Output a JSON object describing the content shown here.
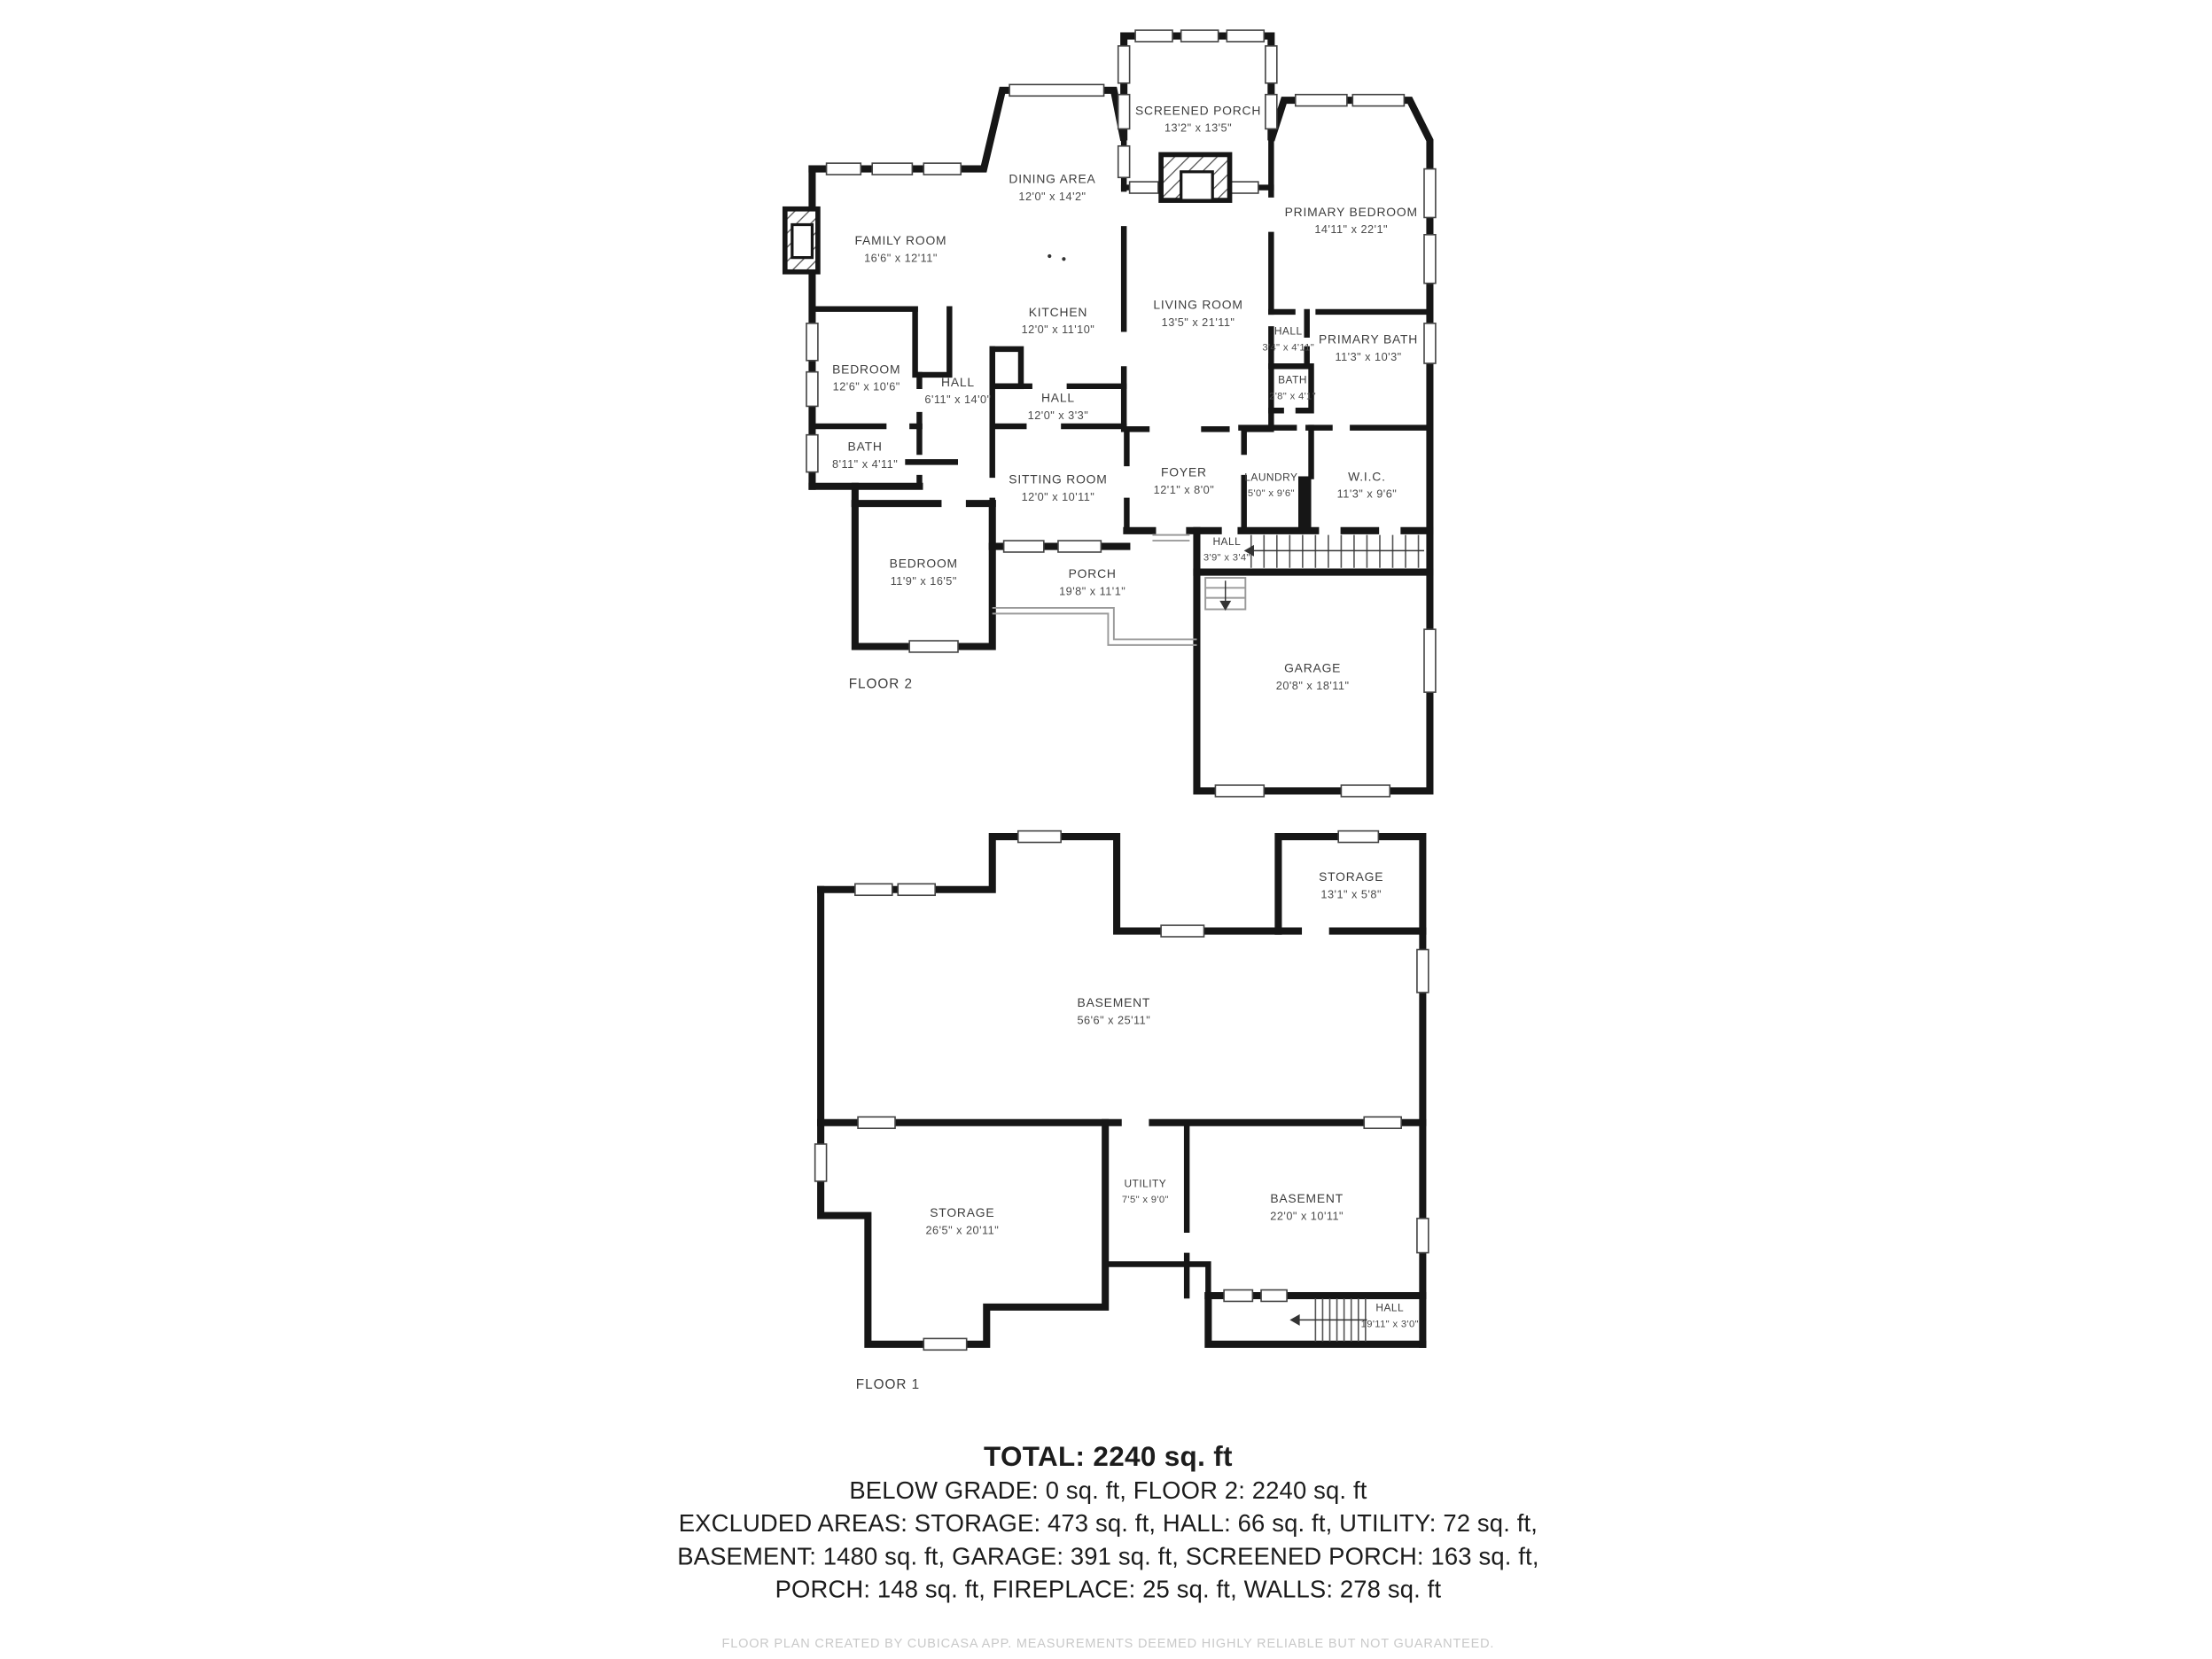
{
  "title": "Floor plan",
  "colors": {
    "background": "#ffffff",
    "wall": "#161616",
    "room_label": "#3d3d3d",
    "dim_label": "#4a4a4a",
    "summary_text": "#1c1c1c",
    "footer_text": "#c9c9c9"
  },
  "floor2": {
    "label": "FLOOR 2",
    "rooms": [
      {
        "name": "SCREENED PORCH",
        "dims": "13'2\" x 13'5\""
      },
      {
        "name": "DINING AREA",
        "dims": "12'0\" x 14'2\""
      },
      {
        "name": "FAMILY ROOM",
        "dims": "16'6\" x 12'11\""
      },
      {
        "name": "PRIMARY BEDROOM",
        "dims": "14'11\" x 22'1\""
      },
      {
        "name": "KITCHEN",
        "dims": "12'0\" x 11'10\""
      },
      {
        "name": "LIVING ROOM",
        "dims": "13'5\" x 21'11\""
      },
      {
        "name": "BEDROOM",
        "dims": "12'6\" x 10'6\""
      },
      {
        "name": "HALL",
        "dims": "6'11\" x 14'0\""
      },
      {
        "name": "HALL",
        "dims": "12'0\" x 3'3\""
      },
      {
        "name": "HALL",
        "dims": "3'4\" x 4'11\""
      },
      {
        "name": "PRIMARY BATH",
        "dims": "11'3\" x 10'3\""
      },
      {
        "name": "BATH",
        "dims": "2'8\" x 4'1\""
      },
      {
        "name": "BATH",
        "dims": "8'11\" x 4'11\""
      },
      {
        "name": "SITTING ROOM",
        "dims": "12'0\" x 10'11\""
      },
      {
        "name": "FOYER",
        "dims": "12'1\" x 8'0\""
      },
      {
        "name": "LAUNDRY",
        "dims": "5'0\" x 9'6\""
      },
      {
        "name": "W.I.C.",
        "dims": "11'3\" x 9'6\""
      },
      {
        "name": "BEDROOM",
        "dims": "11'9\" x 16'5\""
      },
      {
        "name": "PORCH",
        "dims": "19'8\" x 11'1\""
      },
      {
        "name": "HALL",
        "dims": "3'9\" x 3'4\""
      },
      {
        "name": "GARAGE",
        "dims": "20'8\" x 18'11\""
      }
    ]
  },
  "floor1": {
    "label": "FLOOR 1",
    "rooms": [
      {
        "name": "STORAGE",
        "dims": "13'1\" x 5'8\""
      },
      {
        "name": "BASEMENT",
        "dims": "56'6\" x 25'11\""
      },
      {
        "name": "UTILITY",
        "dims": "7'5\" x 9'0\""
      },
      {
        "name": "BASEMENT",
        "dims": "22'0\" x 10'11\""
      },
      {
        "name": "STORAGE",
        "dims": "26'5\" x 20'11\""
      },
      {
        "name": "HALL",
        "dims": "19'11\" x 3'0\""
      }
    ]
  },
  "summary": {
    "total": "TOTAL: 2240 sq. ft",
    "lines": [
      "BELOW GRADE: 0 sq. ft, FLOOR 2: 2240 sq. ft",
      "EXCLUDED AREAS: STORAGE: 473 sq. ft, HALL: 66 sq. ft, UTILITY: 72 sq. ft,",
      "BASEMENT: 1480 sq. ft, GARAGE: 391 sq. ft, SCREENED PORCH: 163 sq. ft,",
      "PORCH: 148 sq. ft, FIREPLACE: 25 sq. ft, WALLS: 278 sq. ft"
    ]
  },
  "footer": "FLOOR PLAN CREATED BY CUBICASA APP. MEASUREMENTS DEEMED HIGHLY RELIABLE BUT NOT GUARANTEED."
}
